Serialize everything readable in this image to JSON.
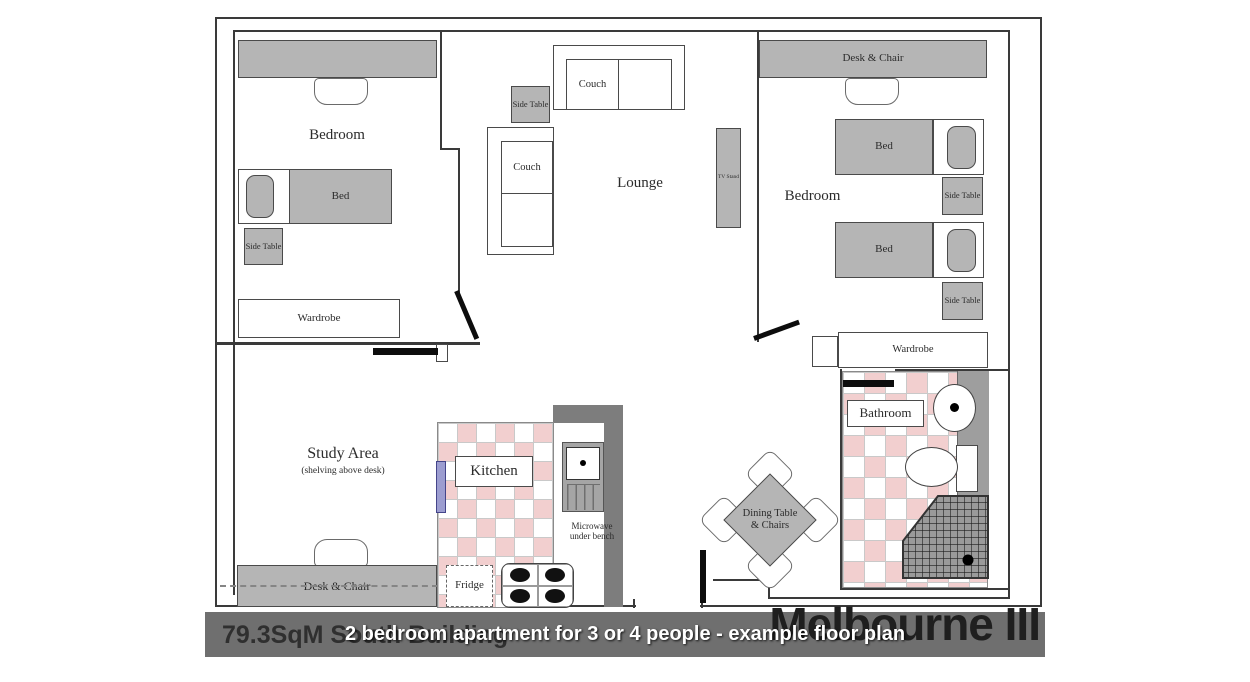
{
  "plan": {
    "bedroom1": {
      "room_label": "Bedroom",
      "bed_label": "Bed",
      "side_table_label": "Side Table",
      "wardrobe_label": "Wardrobe"
    },
    "lounge": {
      "room_label": "Lounge",
      "couch_top_label": "Couch",
      "couch_side_label": "Couch",
      "side_table_label": "Side Table",
      "tv_stand_label": "TV Stand"
    },
    "bedroom2": {
      "room_label": "Bedroom",
      "desk_chair_label": "Desk & Chair",
      "bed_top_label": "Bed",
      "bed_bottom_label": "Bed",
      "side_table_top_label": "Side Table",
      "side_table_bottom_label": "Side Table",
      "wardrobe_label": "Wardrobe"
    },
    "study": {
      "room_label": "Study Area",
      "room_sublabel": "(shelving above desk)",
      "desk_chair_label": "Desk & Chair"
    },
    "kitchen": {
      "room_label": "Kitchen",
      "microwave_label_line1": "Microwave",
      "microwave_label_line2": "under bench",
      "fridge_label": "Fridge"
    },
    "bathroom": {
      "room_label": "Bathroom"
    },
    "dining": {
      "label_line1": "Dining Table",
      "label_line2": "& Chairs"
    }
  },
  "footer": {
    "area_label": "79.3SqM South Building",
    "plan_name": "Melbourne III",
    "caption": "2 bedroom apartment for 3 or 4 people - example floor plan"
  },
  "colors": {
    "tile_pink": "#f2cfcf",
    "furniture_gray": "#b5b5b5",
    "wall_gray": "#7d7d7d",
    "footer_bar_gray": "#6f6f6f",
    "door_black": "#0d0d0d",
    "caption_white": "#ffffff"
  }
}
